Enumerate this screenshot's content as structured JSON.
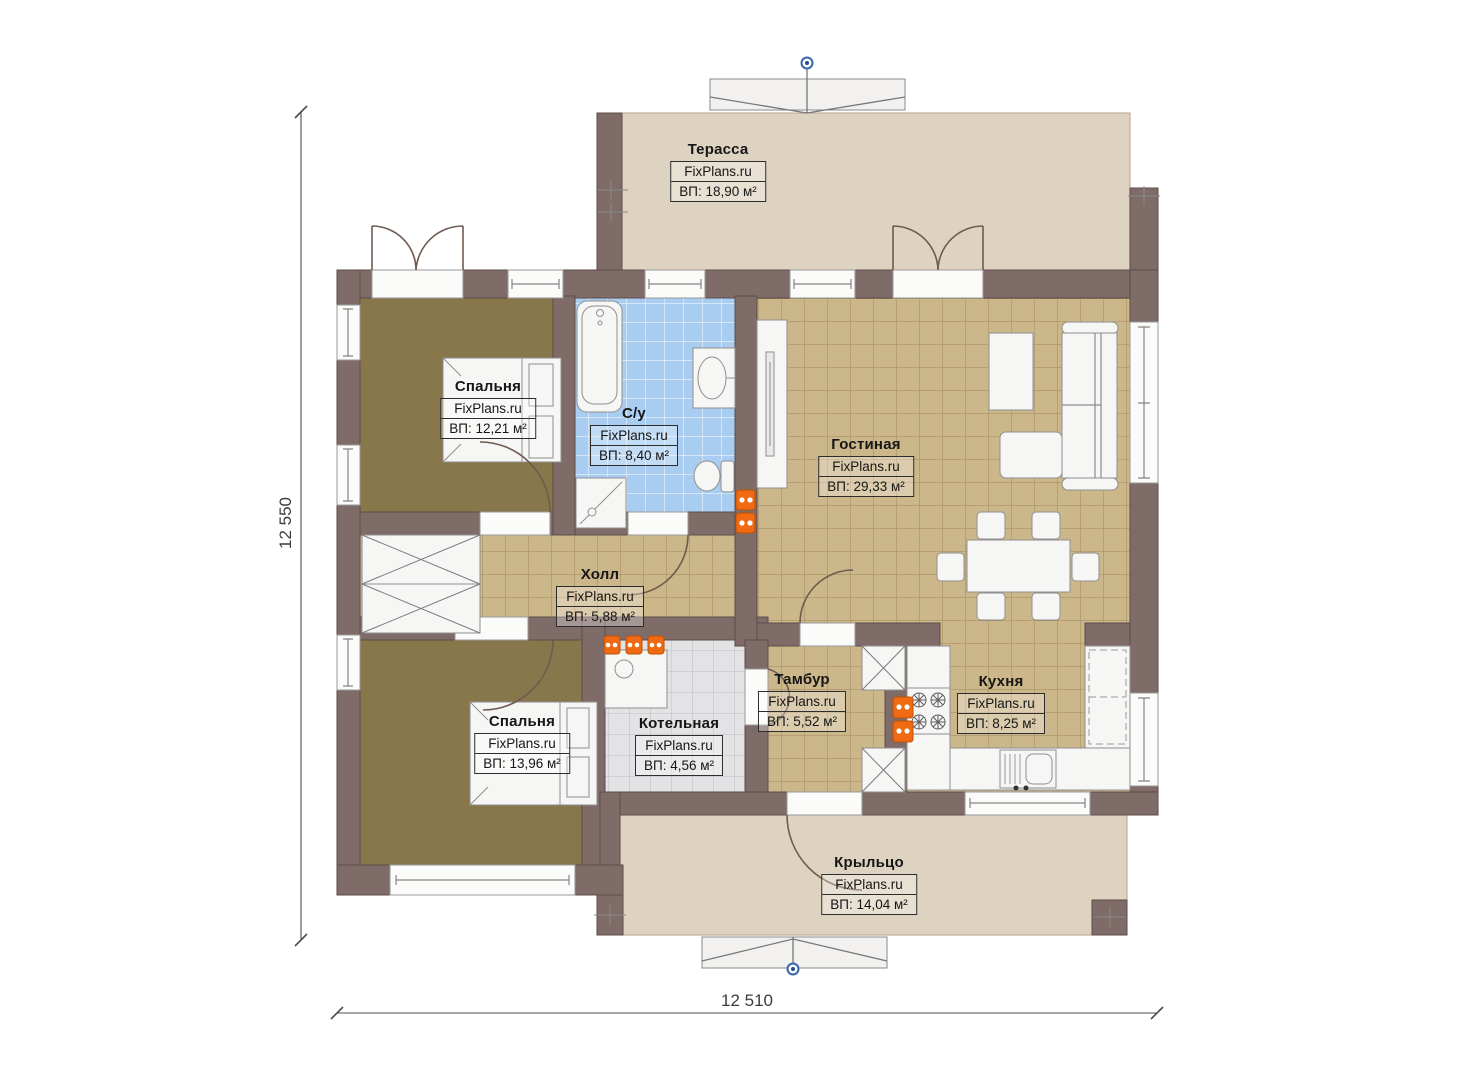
{
  "plan": {
    "brand": "FixPlans.ru",
    "dimensions": {
      "height_label": "12 550",
      "width_label": "12 510"
    },
    "rooms": [
      {
        "id": "terrace",
        "name": "Терасса",
        "area": "ВП: 18,90 м²"
      },
      {
        "id": "bedroom1",
        "name": "Спальня",
        "area": "ВП: 12,21 м²"
      },
      {
        "id": "bathroom",
        "name": "С/у",
        "area": "ВП: 8,40 м²"
      },
      {
        "id": "living",
        "name": "Гостиная",
        "area": "ВП: 29,33 м²"
      },
      {
        "id": "hall",
        "name": "Холл",
        "area": "ВП: 5,88 м²"
      },
      {
        "id": "bedroom2",
        "name": "Спальня",
        "area": "ВП: 13,96 м²"
      },
      {
        "id": "boiler",
        "name": "Котельная",
        "area": "ВП: 4,56 м²"
      },
      {
        "id": "tambour",
        "name": "Тамбур",
        "area": "ВП: 5,52 м²"
      },
      {
        "id": "kitchen",
        "name": "Кухня",
        "area": "ВП: 8,25 м²"
      },
      {
        "id": "porch",
        "name": "Крыльцо",
        "area": "ВП: 14,04 м²"
      }
    ],
    "colors": {
      "wall": "#7f6b67",
      "terrace_floor": "#ded3c1",
      "bedroom_floor": "#87774a",
      "tile_floor": "#ccb78a",
      "bath_tile": "#a9cdf1",
      "boiler_tile": "#e3e3e5",
      "furniture": "#f6f6f5",
      "radiator": "#f06a14",
      "marker_blue": "#3a66b0"
    }
  }
}
